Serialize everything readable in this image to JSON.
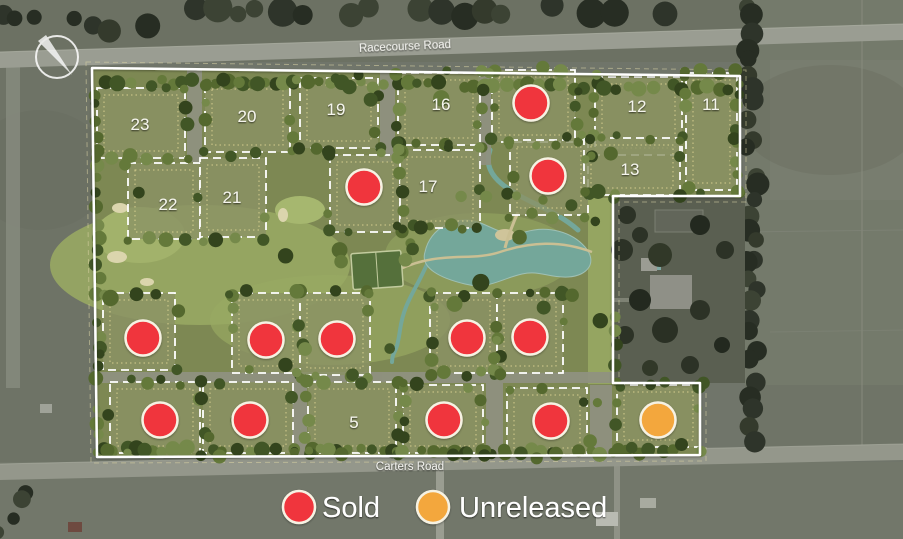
{
  "roads": [
    {
      "name": "Racecourse Road"
    },
    {
      "name": "Carters Road"
    }
  ],
  "legend": {
    "items": [
      {
        "label": "Sold",
        "status": "sold"
      },
      {
        "label": "Unreleased",
        "status": "unreleased"
      }
    ]
  },
  "status_colors": {
    "sold": "#f0353c",
    "unreleased": "#f3a73e"
  },
  "marker_border_color": "#f6f2e3",
  "lots": [
    {
      "label": "23",
      "rect": [
        97,
        88,
        88,
        70
      ],
      "label_pos": [
        140,
        124
      ]
    },
    {
      "label": "20",
      "rect": [
        205,
        82,
        85,
        70
      ],
      "label_pos": [
        247,
        116
      ]
    },
    {
      "label": "19",
      "rect": [
        300,
        78,
        78,
        70
      ],
      "label_pos": [
        336,
        109
      ]
    },
    {
      "label": "16",
      "rect": [
        398,
        73,
        82,
        72
      ],
      "label_pos": [
        441,
        104
      ]
    },
    {
      "status": "sold",
      "rect": [
        492,
        70,
        83,
        72
      ],
      "marker": [
        531,
        103
      ]
    },
    {
      "label": "12",
      "rect": [
        595,
        77,
        87,
        78
      ],
      "label_pos": [
        637,
        106
      ]
    },
    {
      "label": "11",
      "rect": [
        686,
        73,
        51,
        117
      ],
      "label_pos": [
        711,
        104
      ]
    },
    {
      "status": "sold",
      "rect": [
        510,
        140,
        78,
        75
      ],
      "marker": [
        548,
        176
      ]
    },
    {
      "label": "13",
      "rect": [
        584,
        138,
        96,
        57
      ],
      "label_pos": [
        630,
        169
      ]
    },
    {
      "label": "22",
      "rect": [
        128,
        163,
        72,
        76
      ],
      "label_pos": [
        168,
        204
      ]
    },
    {
      "label": "21",
      "rect": [
        200,
        158,
        66,
        79
      ],
      "label_pos": [
        232,
        197
      ]
    },
    {
      "status": "sold",
      "rect": [
        330,
        155,
        70,
        77
      ],
      "marker": [
        364,
        187
      ]
    },
    {
      "label": "17",
      "rect": [
        400,
        150,
        80,
        78
      ],
      "label_pos": [
        428,
        186
      ]
    },
    {
      "status": "sold",
      "rect": [
        103,
        293,
        72,
        77
      ],
      "marker": [
        143,
        338
      ]
    },
    {
      "status": "sold",
      "rect": [
        232,
        293,
        68,
        80
      ],
      "marker": [
        266,
        340
      ]
    },
    {
      "status": "sold",
      "rect": [
        300,
        293,
        70,
        82
      ],
      "marker": [
        337,
        339
      ]
    },
    {
      "status": "sold",
      "rect": [
        430,
        293,
        67,
        80
      ],
      "marker": [
        467,
        338
      ]
    },
    {
      "status": "sold",
      "rect": [
        497,
        293,
        66,
        80
      ],
      "marker": [
        530,
        337
      ]
    },
    {
      "status": "sold",
      "rect": [
        110,
        382,
        90,
        71
      ],
      "marker": [
        160,
        420
      ]
    },
    {
      "status": "sold",
      "rect": [
        203,
        382,
        90,
        71
      ],
      "marker": [
        250,
        420
      ]
    },
    {
      "label": "5",
      "rect": [
        308,
        382,
        88,
        71
      ],
      "label_pos": [
        354,
        422
      ]
    },
    {
      "status": "sold",
      "rect": [
        403,
        385,
        80,
        68
      ],
      "marker": [
        444,
        420
      ]
    },
    {
      "status": "sold",
      "rect": [
        507,
        388,
        80,
        67
      ],
      "marker": [
        551,
        421
      ]
    },
    {
      "status": "unreleased",
      "rect": [
        617,
        385,
        83,
        62
      ],
      "marker": [
        658,
        420
      ]
    }
  ]
}
